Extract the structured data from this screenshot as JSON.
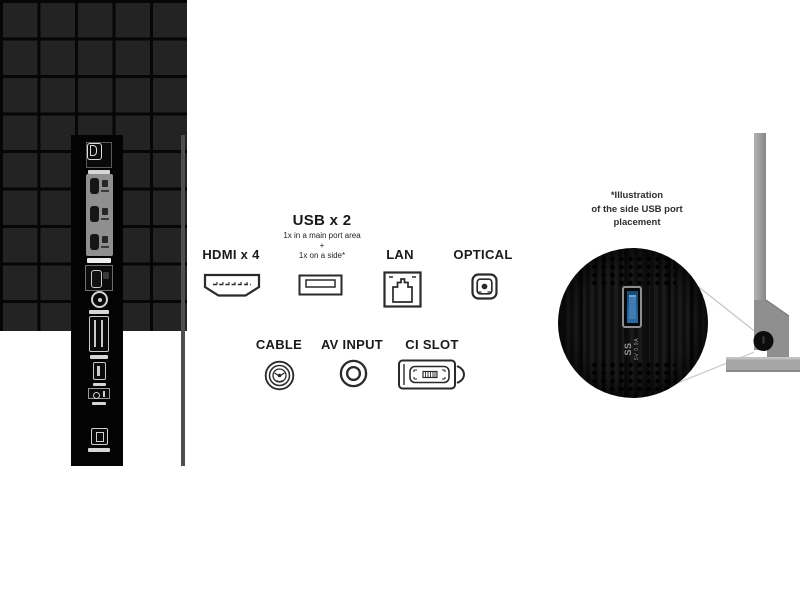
{
  "legend": {
    "hdmi": {
      "label": "HDMI x 4"
    },
    "usb": {
      "label": "USB x 2",
      "note_line1": "1x in a main port area",
      "note_plus": "+",
      "note_line2": "1x on a side*"
    },
    "lan": {
      "label": "LAN"
    },
    "optical": {
      "label": "OPTICAL"
    },
    "cable": {
      "label": "CABLE"
    },
    "av_input": {
      "label": "AV INPUT"
    },
    "ci_slot": {
      "label": "CI SLOT"
    }
  },
  "side_usb_note": {
    "line1": "*Illustration",
    "line2": "of the side USB port",
    "line3": "placement"
  },
  "usb_zoom": {
    "superspeed": "SS",
    "rating": "5V 0.9A"
  },
  "colors": {
    "usb_port_blue": "#2e6ba5",
    "tv_profile_gray": "#9a9a9a",
    "panel_dark": "#232323",
    "icon_stroke": "#2a2a2a"
  }
}
